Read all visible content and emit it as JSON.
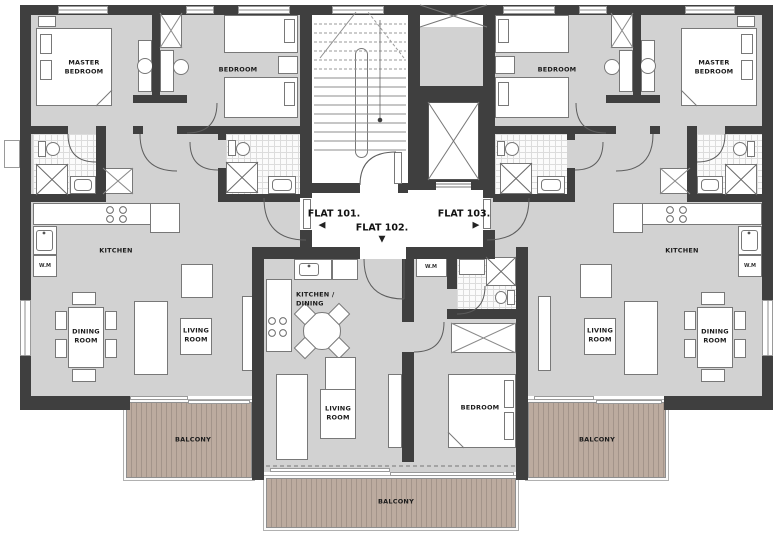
{
  "flats": {
    "f101": {
      "label": "FLAT 101.",
      "arrow": "◀"
    },
    "f102": {
      "label": "FLAT 102.",
      "arrow": "▼"
    },
    "f103": {
      "label": "FLAT 103.",
      "arrow": "▶"
    }
  },
  "labels": {
    "master_bedroom": "MASTER BEDROOM",
    "bedroom": "BEDROOM",
    "kitchen": "KITCHEN",
    "kitchen_dining": "KITCHEN / DINING",
    "dining_room": "DINING ROOM",
    "living_room": "LIVING ROOM",
    "balcony": "BALCONY",
    "wm": "W.M"
  },
  "colors": {
    "wall": "#3f3f3f",
    "floor": "#d2d2d2",
    "deck": "#bcab9f",
    "core": "#ffffff"
  }
}
